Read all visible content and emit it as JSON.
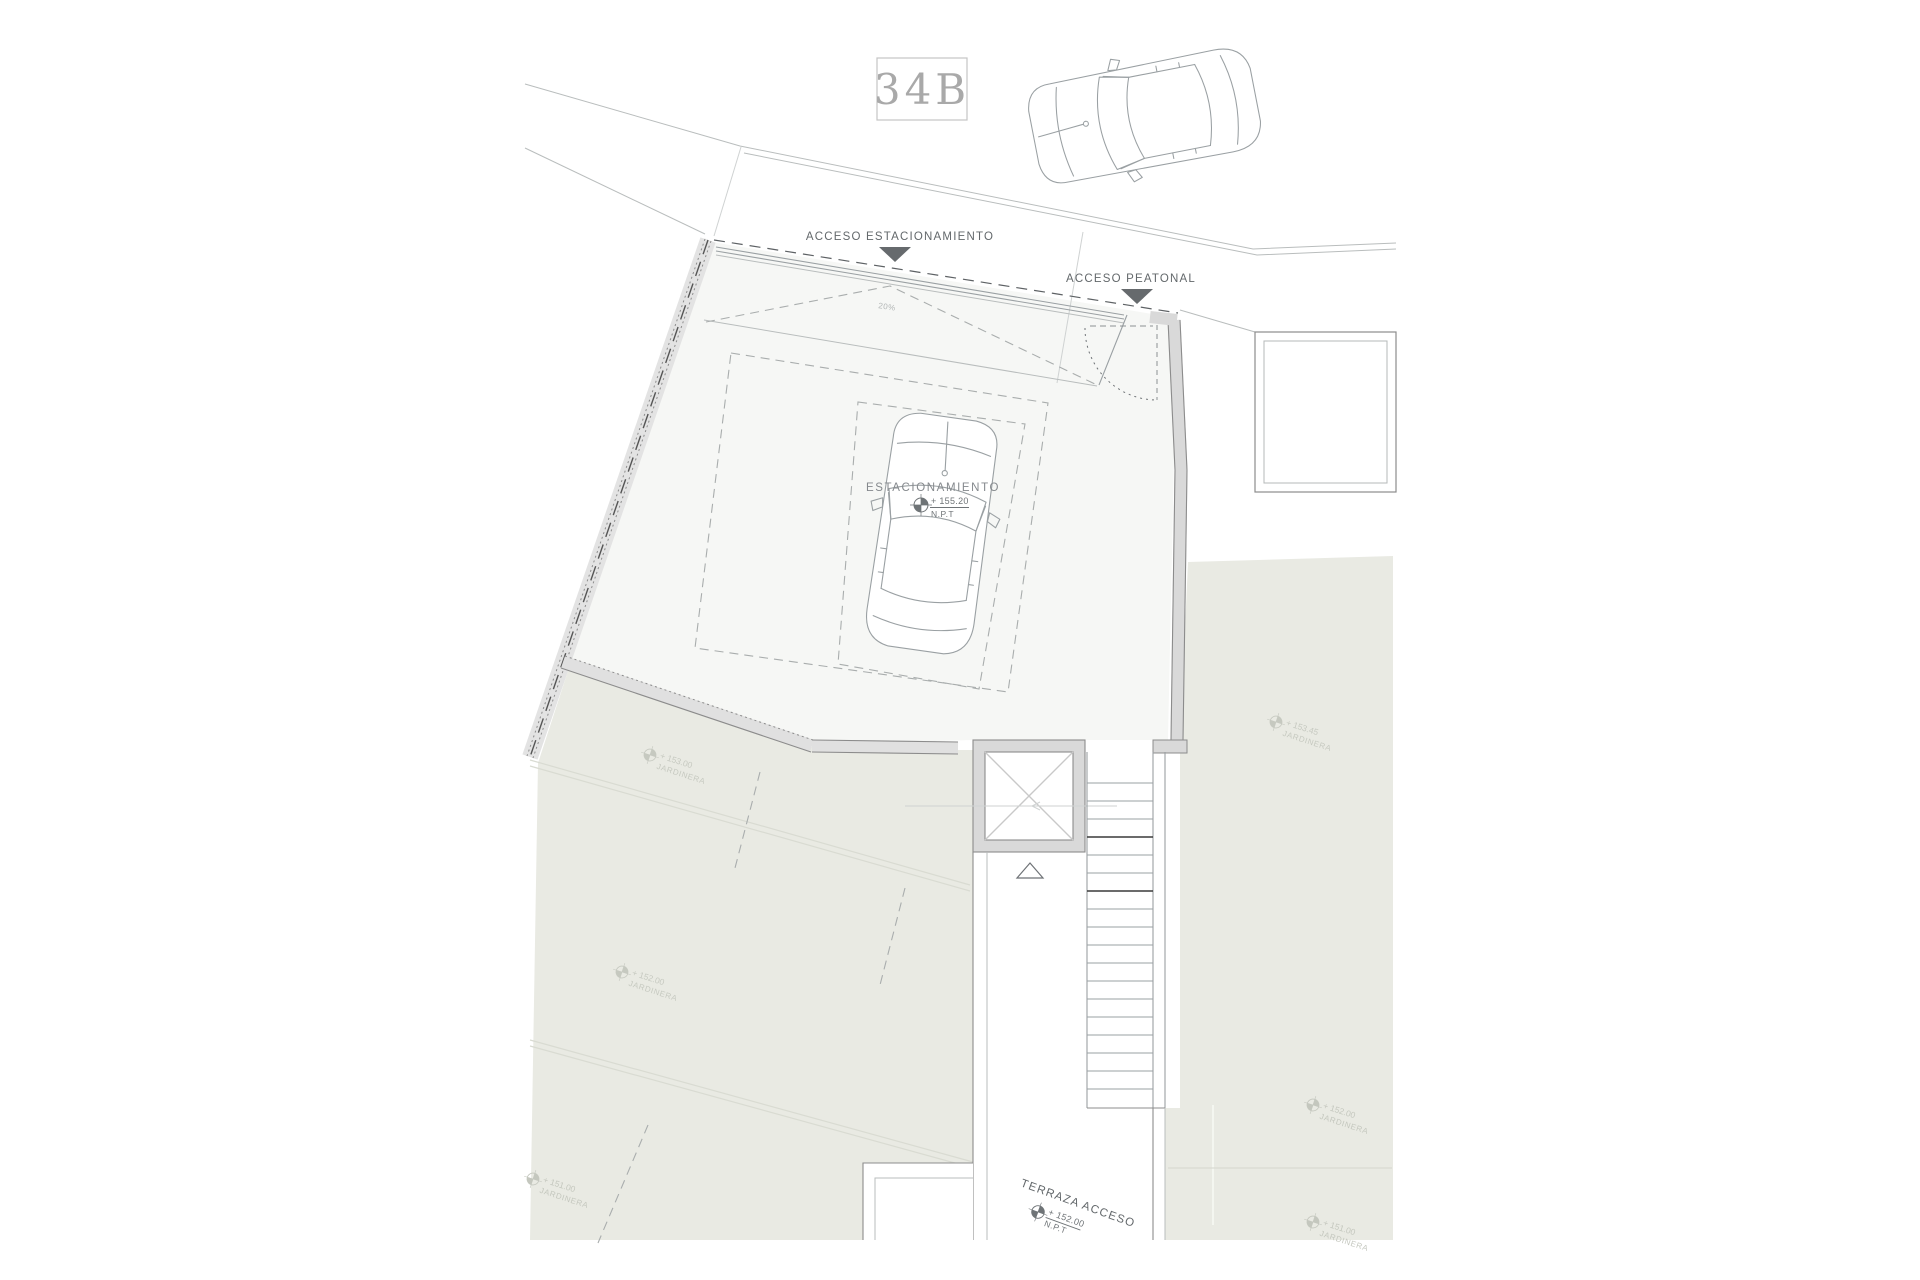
{
  "plan": {
    "unit_label": "34B",
    "labels": {
      "acceso_estacionamiento": "ACCESO ESTACIONAMIENTO",
      "acceso_peatonal": "ACCESO PEATONAL",
      "estacionamiento": "ESTACIONAMIENTO",
      "terraza_acceso": "TERRAZA ACCESO",
      "slope": "20%"
    },
    "levels": {
      "estacionamiento": {
        "value": "+ 155.20",
        "datum": "N.P.T"
      },
      "terraza": {
        "value": "+ 152.00",
        "datum": "N.P.T"
      }
    },
    "jardinera_markers": [
      {
        "value": "+ 153.00",
        "label": "JARDINERA"
      },
      {
        "value": "+ 152.00",
        "label": "JARDINERA"
      },
      {
        "value": "+ 151.00",
        "label": "JARDINERA"
      },
      {
        "value": "+ 153.45",
        "label": "JARDINERA"
      },
      {
        "value": "+ 152.00",
        "label": "JARDINERA"
      },
      {
        "value": "+ 151.00",
        "label": "JARDINERA"
      }
    ],
    "colors": {
      "green_area": "#e9eae3",
      "wall": "#d9d9d9",
      "wall_light": "#e3e3e3",
      "arrow": "#666a6d",
      "lot_floor": "#f6f7f5"
    }
  }
}
